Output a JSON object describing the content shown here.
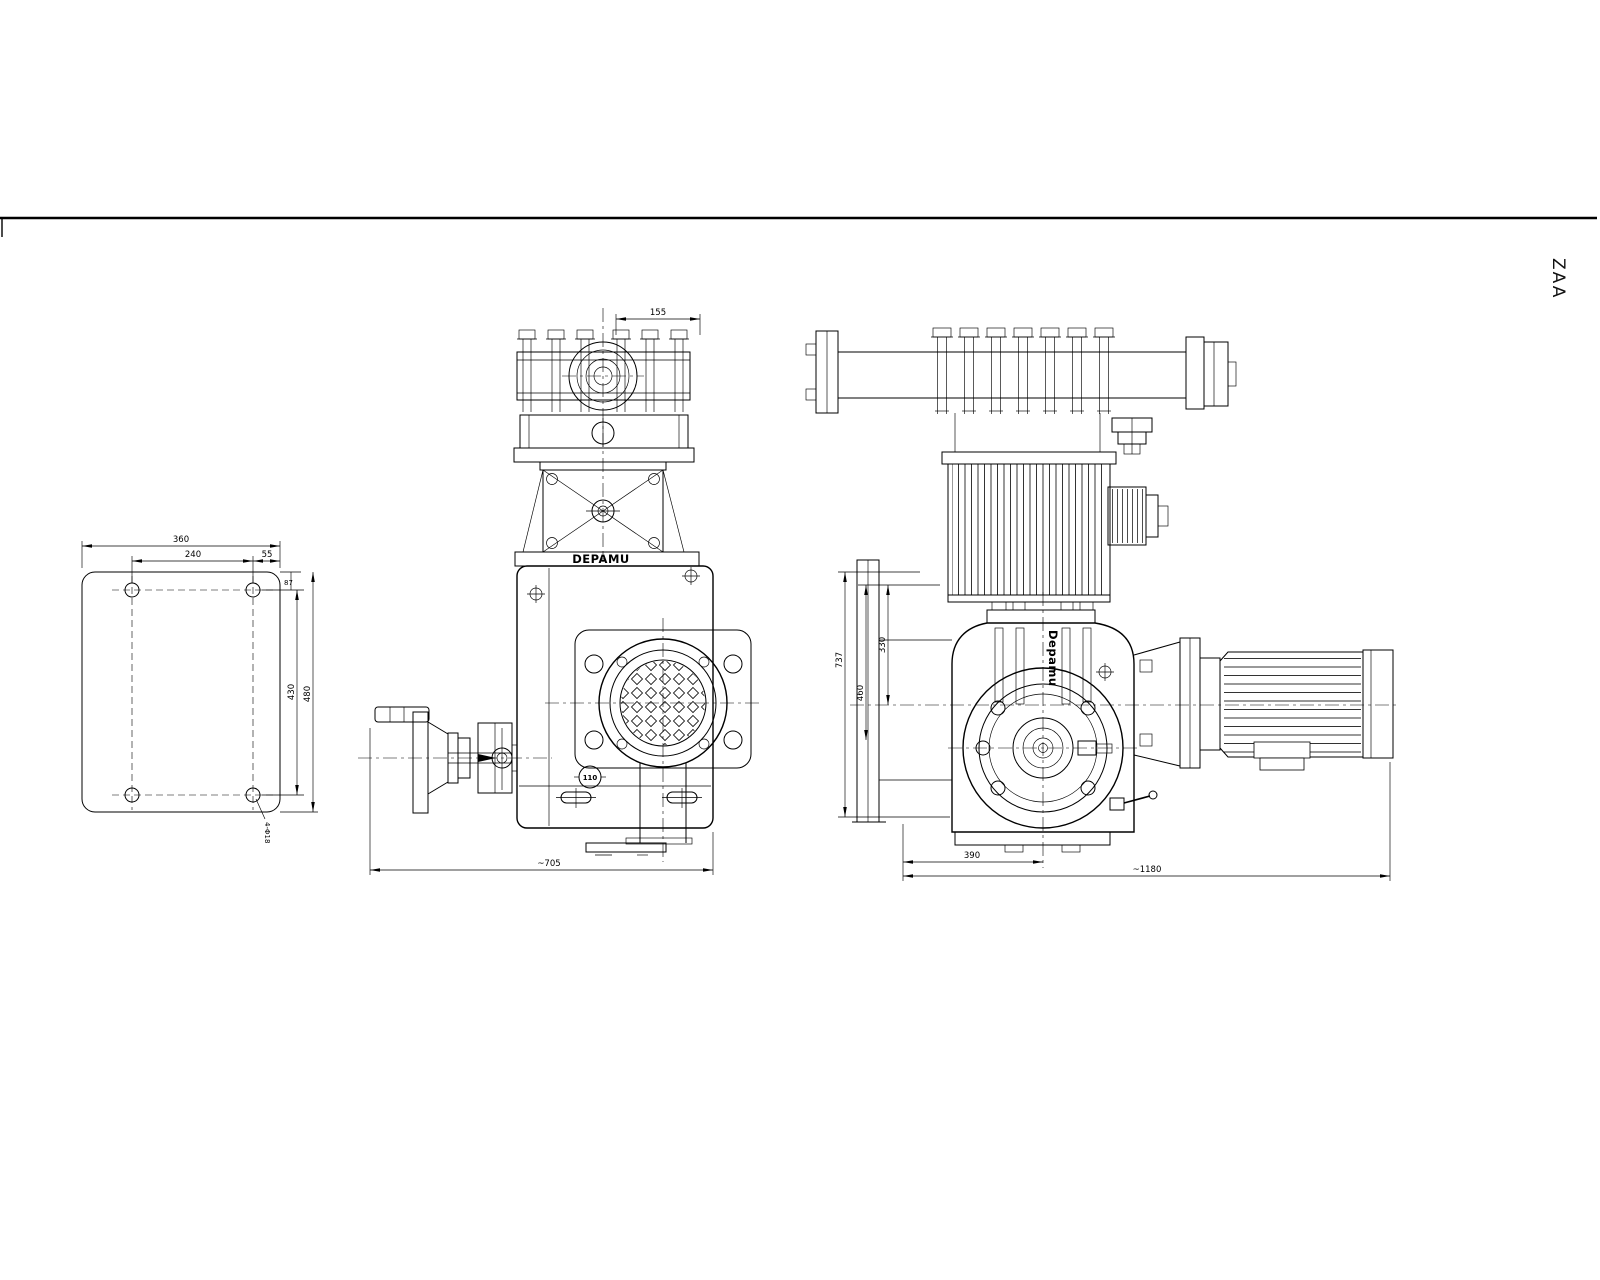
{
  "labels": {
    "zone": "ZAA",
    "brand_front": "DEPAMU",
    "brand_side": "Depamu",
    "sight_glass": "110"
  },
  "dims": {
    "base": {
      "width": "360",
      "hole_span_x": "240",
      "edge_x": "55",
      "edge_y": "87",
      "hole_span_y": "430",
      "height": "480",
      "holes": "4-Φ18"
    },
    "front": {
      "head_width": "155",
      "overall_width": "~705"
    },
    "side": {
      "h_overall": "737",
      "h_mid": "460",
      "h_upper": "330",
      "base_len": "390",
      "overall_len": "~1180"
    }
  }
}
